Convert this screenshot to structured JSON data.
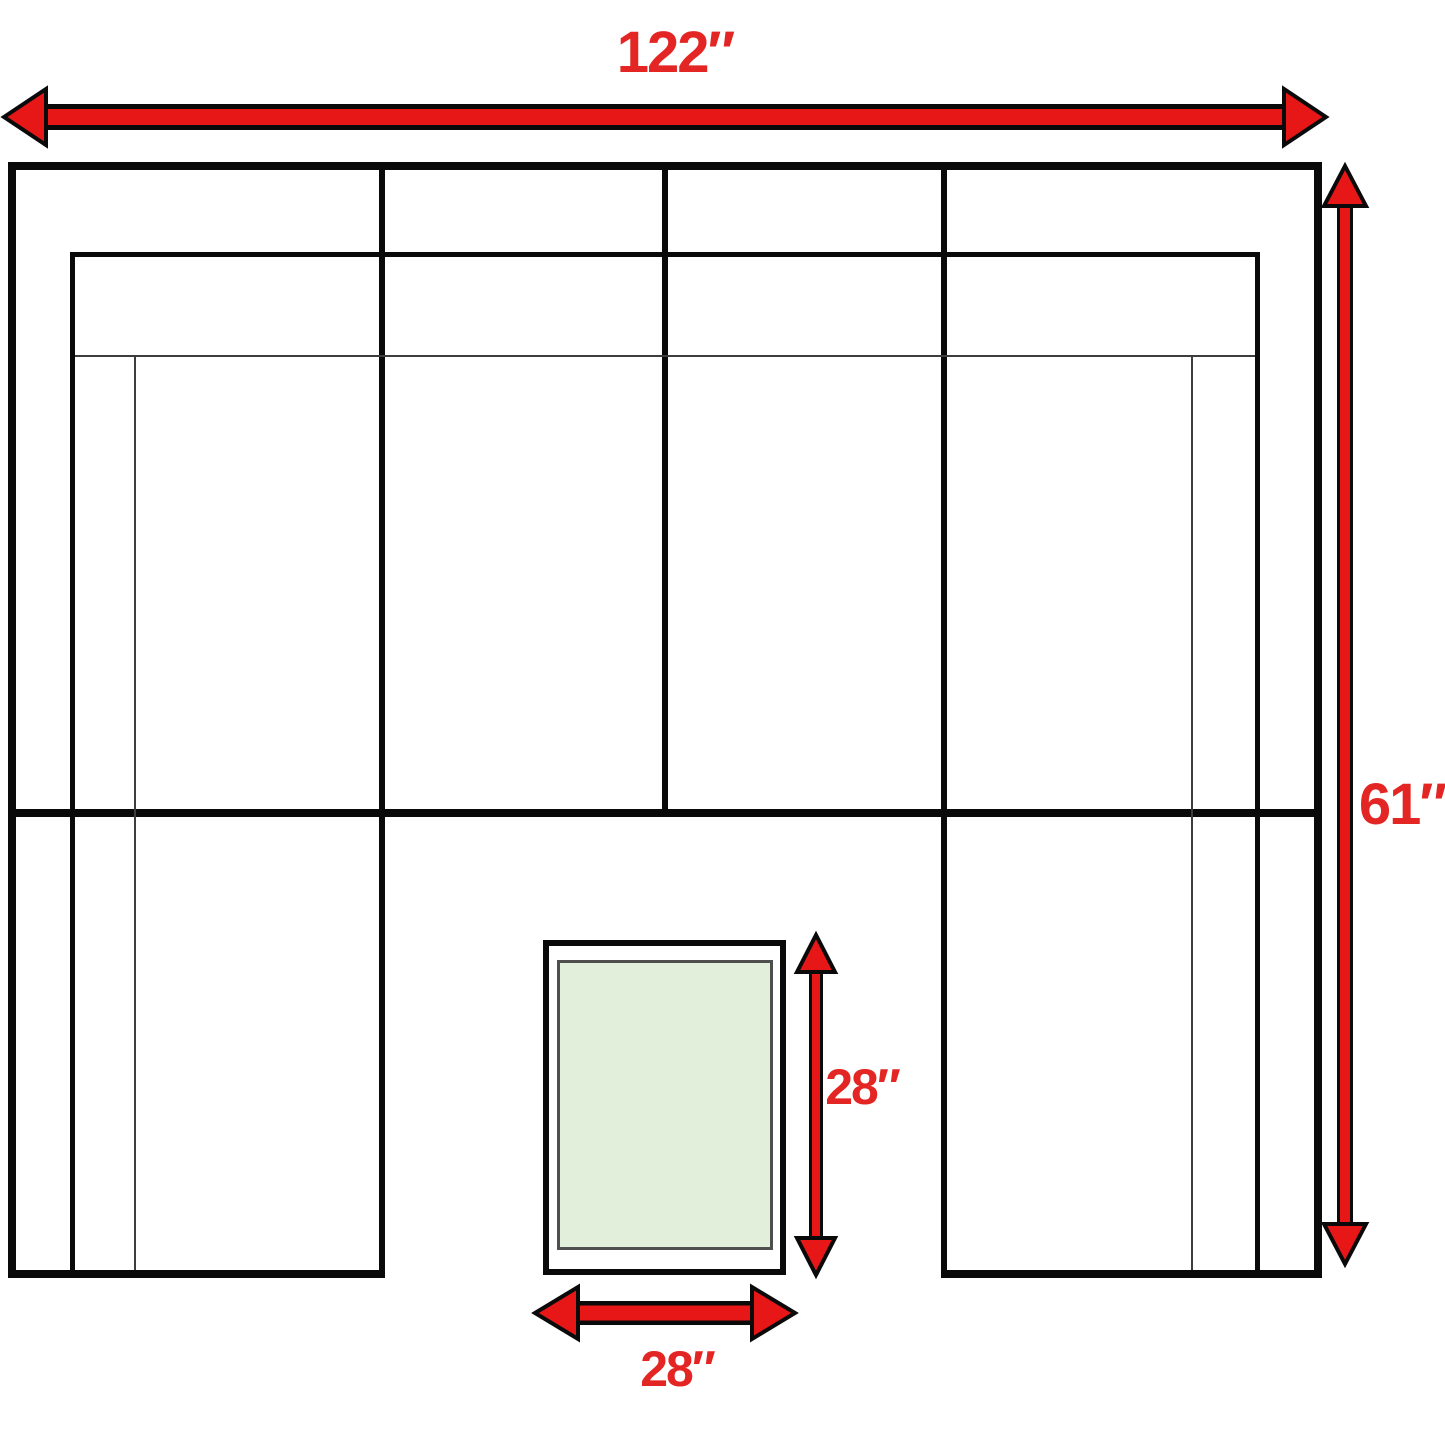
{
  "diagram": {
    "labels": {
      "overall_width": "122″",
      "overall_depth": "61″",
      "ottoman_depth": "28″",
      "ottoman_width": "28″"
    }
  },
  "colors": {
    "arrow_red": "#e81717",
    "label_red": "#e32623",
    "line_black": "#0a0a0a",
    "thin_line": "#3d3d3d",
    "ottoman_fill": "#e2efdb",
    "ottoman_inner_border": "#4f4f4f",
    "background": "#ffffff"
  }
}
